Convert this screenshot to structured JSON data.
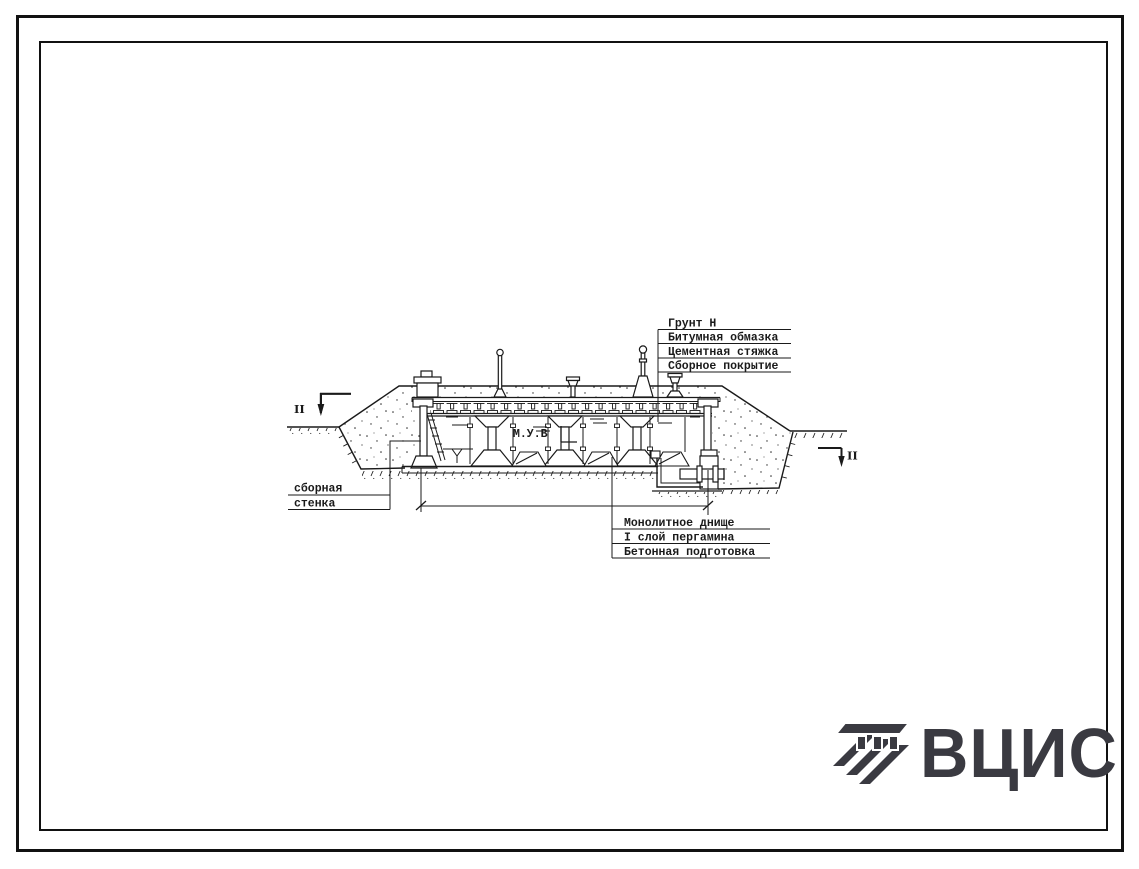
{
  "callouts": {
    "top_right": {
      "items": [
        "Грунт Н",
        "Битумная обмазка",
        "Цементная стяжка",
        "Сборное покрытие"
      ]
    },
    "left": {
      "items": [
        "сборная",
        "стенка"
      ]
    },
    "bottom": {
      "items": [
        "Монолитное днище",
        "I слой пергамина",
        "Бетонная подготовка"
      ]
    }
  },
  "annotations": {
    "water_level": "М.У.В",
    "section_left": "II",
    "section_right": "II"
  },
  "logo": {
    "text": "ВЦИС",
    "color": "#3a3a41"
  },
  "colors": {
    "ink": "#1a1a1a",
    "paper": "#ffffff"
  }
}
